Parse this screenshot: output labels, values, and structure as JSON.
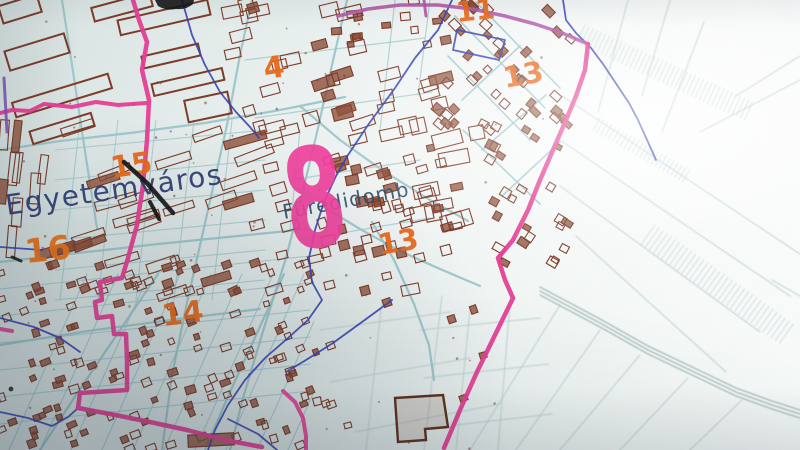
{
  "map": {
    "place_labels": {
      "egyetemvaros": "Egyetemváros",
      "furedidomb": "Füredidomb"
    },
    "district_numbers": {
      "n4": "4",
      "n8": "8",
      "n11": "11",
      "n13a": "13",
      "n13b": "13",
      "n14": "14",
      "n15": "15",
      "n16": "16"
    },
    "colors": {
      "paper": "#e2ebe9",
      "boundary_pink": "#e63d94",
      "boundary_purple": "#b257a6",
      "boundary_blue": "#3642b2",
      "street_teal": "#9cc6ca",
      "field_teal": "#bdd2d1",
      "building_brown": "#7d3a28",
      "building_fill": "#8a4a33",
      "number_orange": "#e8681a",
      "big_number_pink": "#ee3f9b",
      "label_navy": "#2c3a72",
      "label_teal_navy": "#2b4a66",
      "pen_black": "#131313"
    }
  }
}
